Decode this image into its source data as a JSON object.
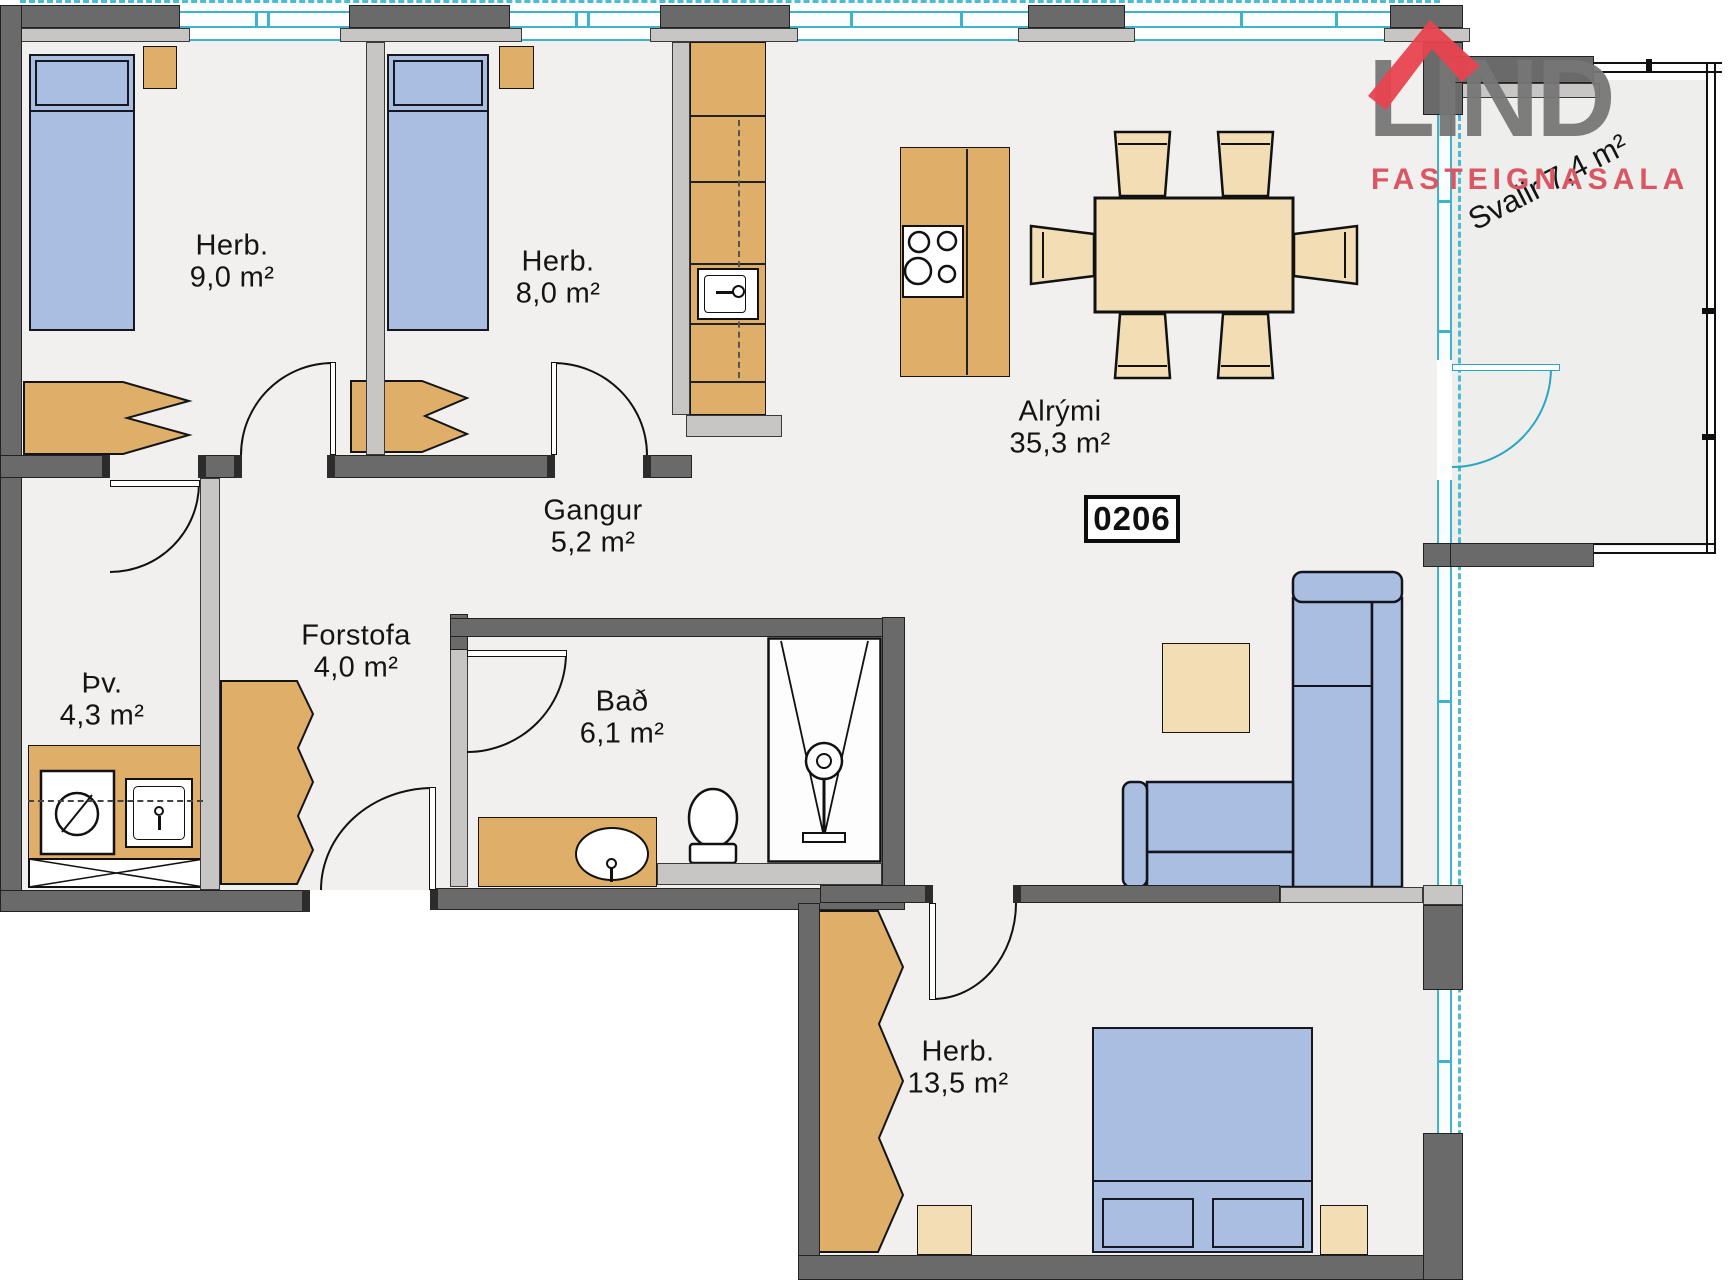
{
  "unit": {
    "number": "0206"
  },
  "logo": {
    "name": "LIND",
    "subtitle": "FASTEIGNASALA",
    "roof_icon": "red-roof-chevron",
    "roof_color": "#e8434f",
    "text_color": "#767676",
    "subtitle_color": "#d95663"
  },
  "rooms": {
    "herb1": {
      "name": "Herb.",
      "area": "9,0 m²"
    },
    "herb2": {
      "name": "Herb.",
      "area": "8,0 m²"
    },
    "alrymi": {
      "name": "Alrými",
      "area": "35,3 m²"
    },
    "gangur": {
      "name": "Gangur",
      "area": "5,2 m²"
    },
    "forstofa": {
      "name": "Forstofa",
      "area": "4,0 m²"
    },
    "thvottahus": {
      "name": "Þv.",
      "area": "4,3 m²"
    },
    "bad": {
      "name": "Bað",
      "area": "6,1 m²"
    },
    "herb3": {
      "name": "Herb.",
      "area": "13,5 m²"
    },
    "svalir": {
      "name": "Svalir",
      "area": "7,4 m²"
    }
  },
  "colors": {
    "wall_dark": "#6a6a6a",
    "wall_light": "#c7c6c4",
    "window_cyan": "#3db3cc",
    "floor": "#f1f0ee",
    "furniture_wood": "#dfae68",
    "furniture_beige": "#f2ddb4",
    "furniture_blue": "#a9bee1"
  }
}
